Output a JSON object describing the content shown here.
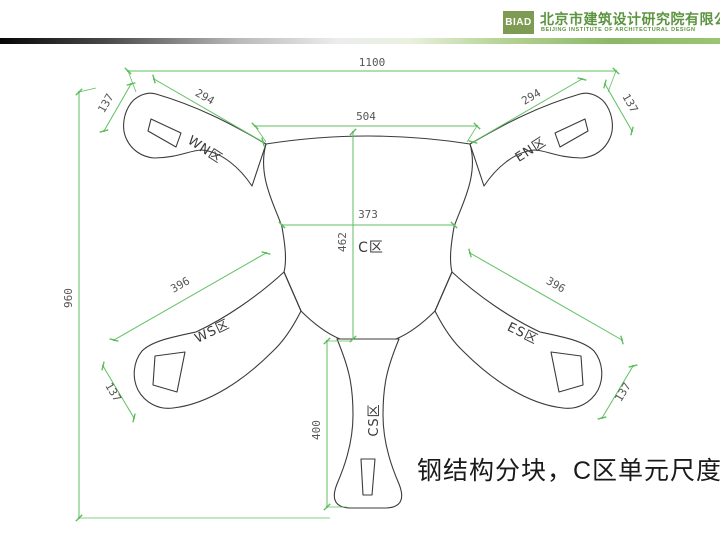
{
  "header": {
    "logo_abbr": "BIAD",
    "company_zh": "北京市建筑设计研究院有限公司",
    "company_en": "BEIJING INSTITUTE OF ARCHITECTURAL DESIGN"
  },
  "caption": "钢结构分块，C区单元尺度大",
  "diagram": {
    "zones": {
      "wn": "WN区",
      "en": "EN区",
      "c": "C区",
      "ws": "WS区",
      "es": "ES区",
      "cs": "CS区"
    },
    "dims": {
      "overall_width": "1100",
      "overall_height": "960",
      "top_center": "504",
      "wn_arm": "294",
      "en_arm": "294",
      "ws_arm": "396",
      "es_arm": "396",
      "c_width": "373",
      "c_height": "462",
      "cs_height": "400",
      "wn_tip": "137",
      "en_tip": "137",
      "ws_tip": "137",
      "es_tip": "137"
    },
    "colors": {
      "dimension_green": "#5fbf5f",
      "outline": "#3b3b3b"
    }
  }
}
